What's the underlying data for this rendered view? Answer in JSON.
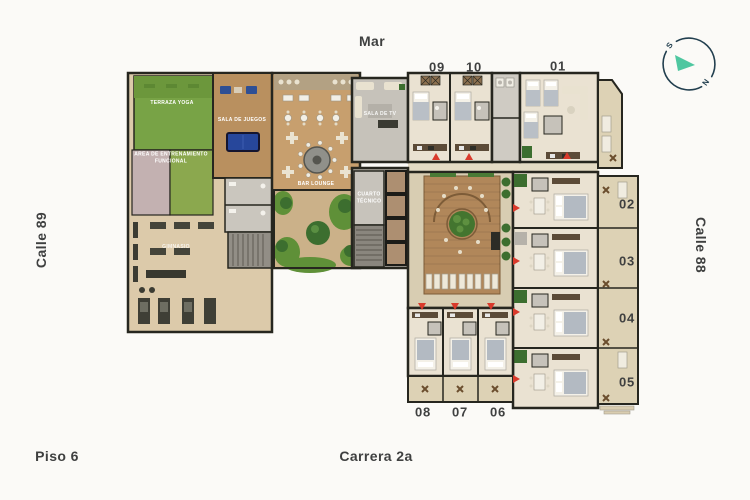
{
  "streets": {
    "top": "Mar",
    "left": "Calle 89",
    "right": "Calle 88",
    "bottom": "Carrera 2a"
  },
  "floor_label": "Piso 6",
  "compass": {
    "south": "S",
    "north": "N"
  },
  "units": {
    "u01": "01",
    "u02": "02",
    "u03": "03",
    "u04": "04",
    "u05": "05",
    "u06": "06",
    "u07": "07",
    "u08": "08",
    "u09": "09",
    "u10": "10"
  },
  "areas": {
    "terraza_yoga": "TERRAZA YOGA",
    "entrenamiento": "AREA DE ENTRENAMIENTO FUNCIONAL",
    "sala_de_juegos": "SALA DE JUEGOS",
    "gimnasio": "GIMNASIO",
    "bar_lounge": "BAR LOUNGE",
    "sala_de_tv": "SALA DE TV",
    "cuarto_tecnico": "CUARTO TÉCNICO"
  },
  "colors": {
    "background": "#fbfaf7",
    "wall": "#26261f",
    "entrance_marker": "#d93a2c",
    "compass_ring": "#223f4f",
    "compass_arrow": "#4fc7a0",
    "grass": "#5f9038",
    "wood_deck": "#b1875a"
  }
}
